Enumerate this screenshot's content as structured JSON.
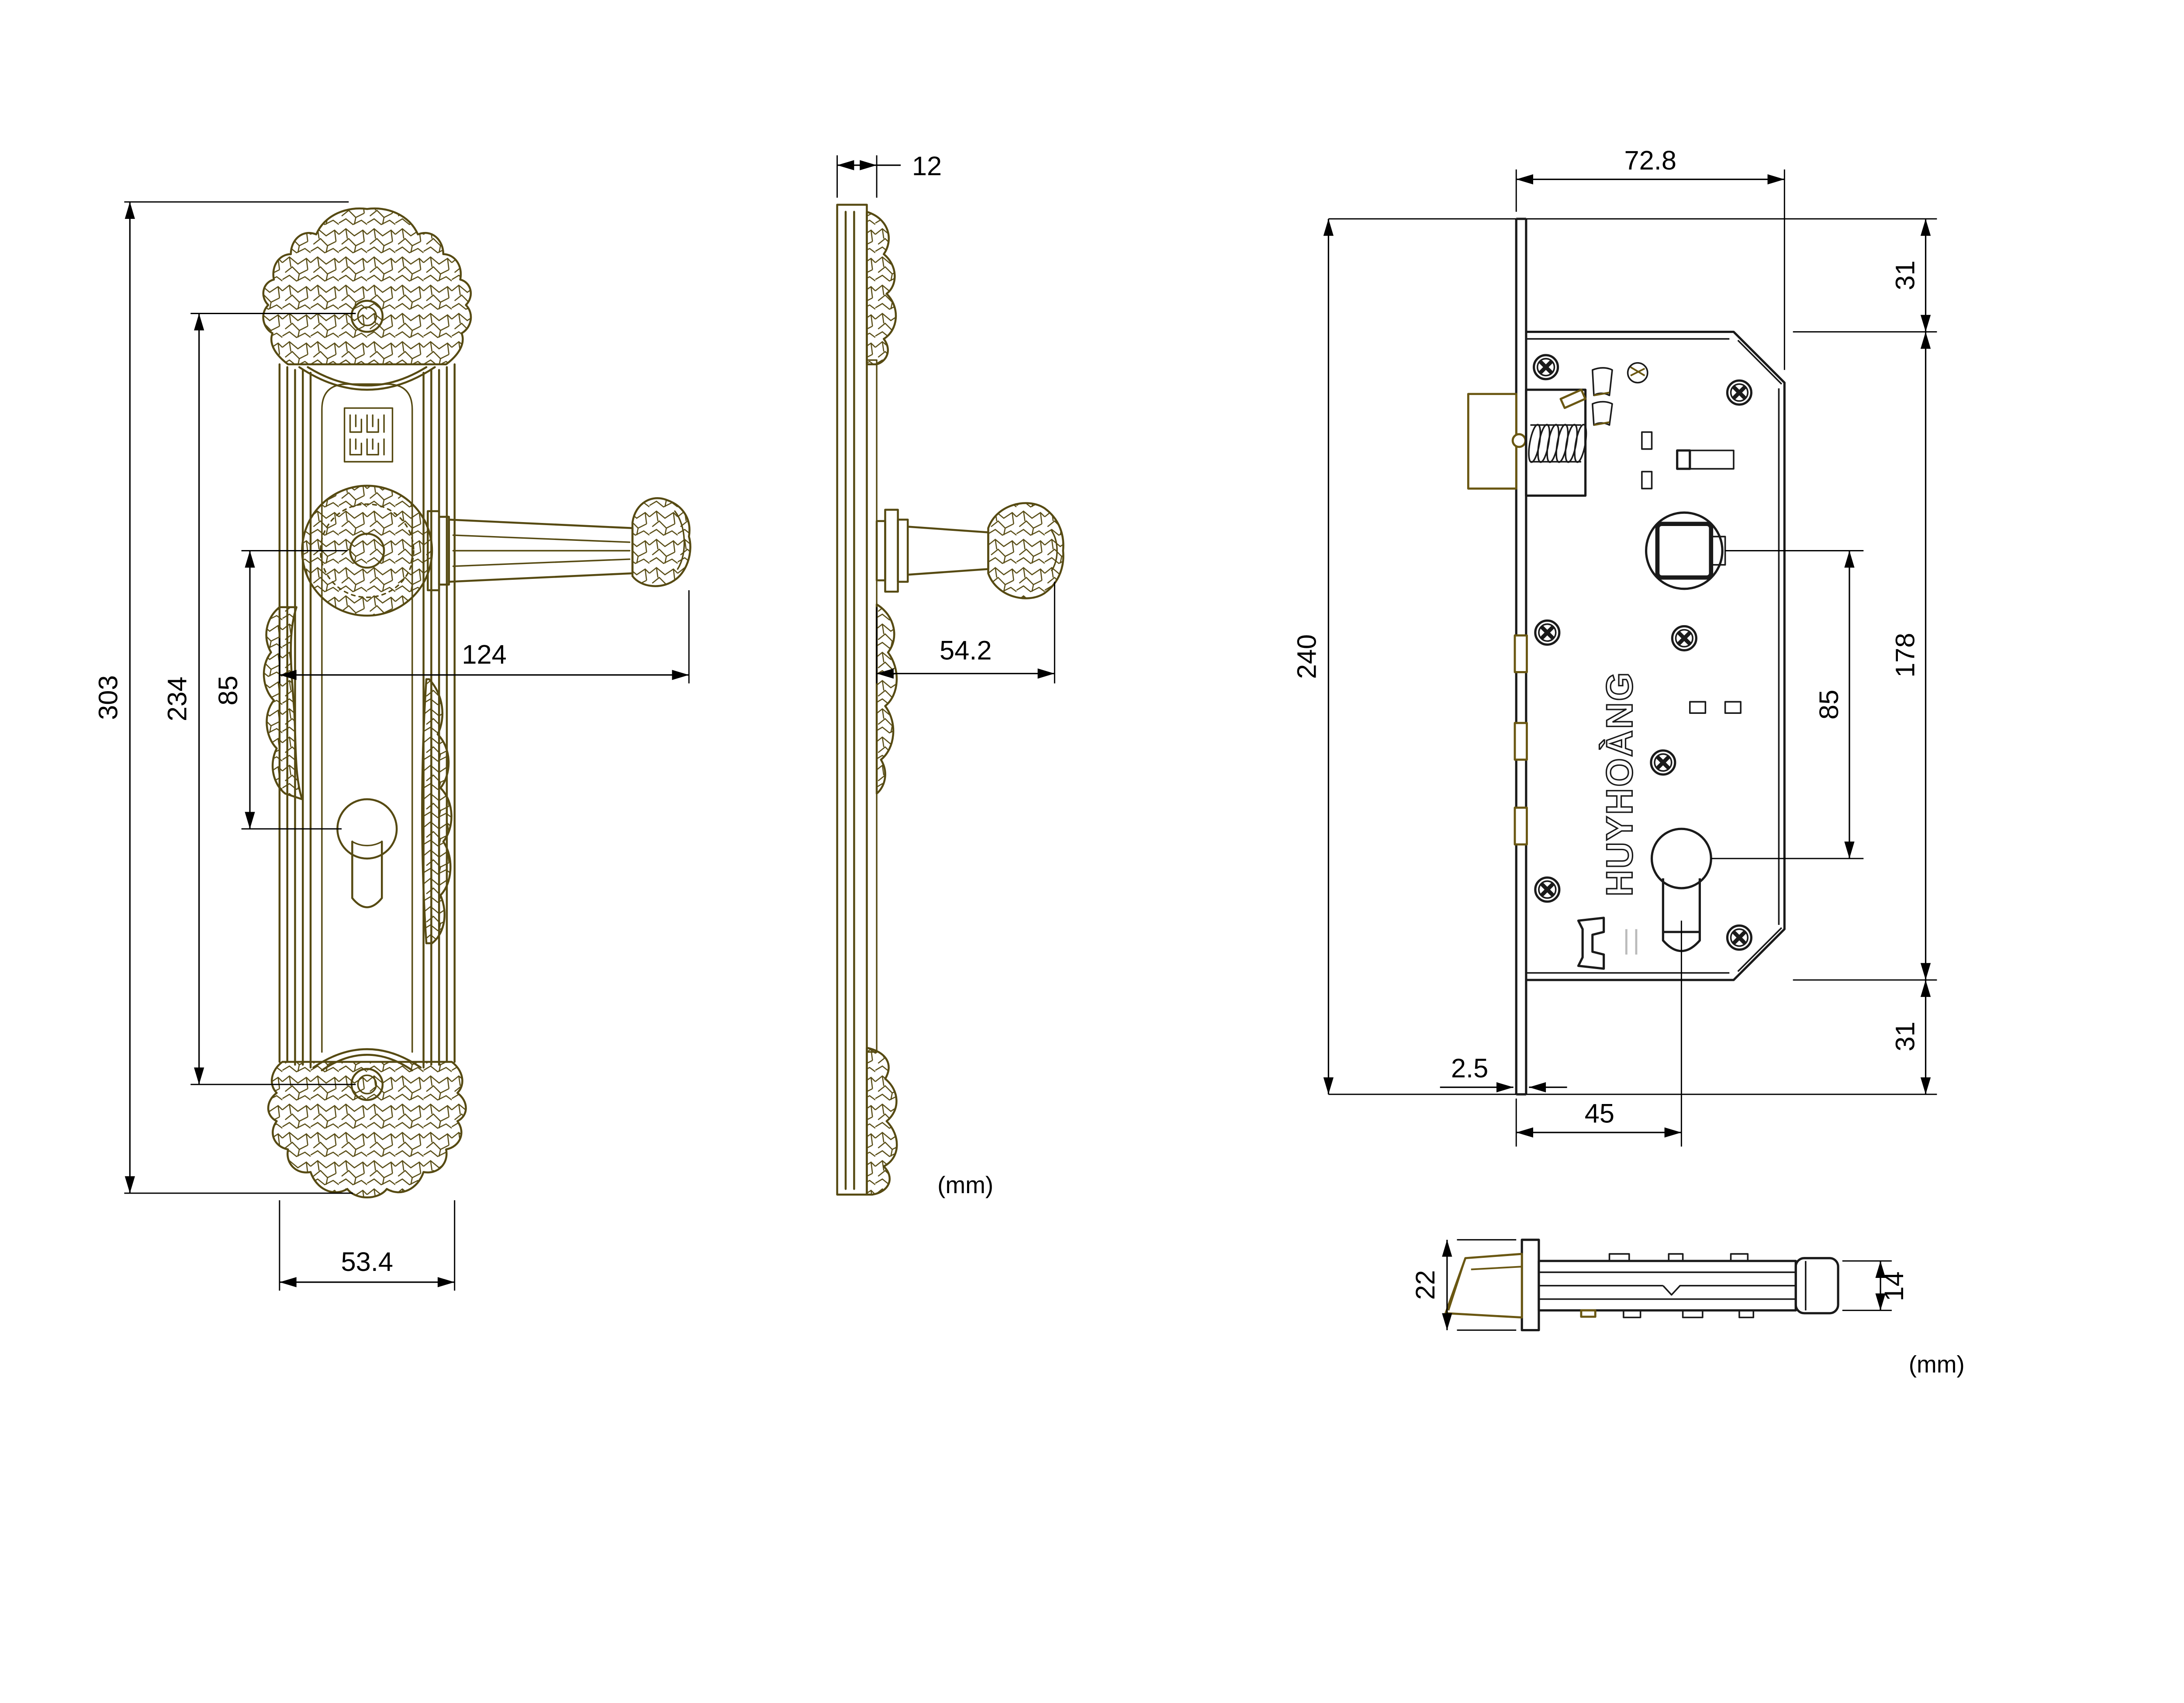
{
  "drawing": {
    "units_note_center": "(mm)",
    "units_note_corner": "(mm)",
    "brand_lock_text": "HUYHOÀNG",
    "brand_seal_text": "MAY MẮN",
    "colors": {
      "hardware_line": "#564a12",
      "lock_line": "#1a1a1a",
      "accent_brass": "#6a5712",
      "dimension": "#000000"
    },
    "views": {
      "handle_plate_front": {
        "dims": {
          "total_height": "303",
          "screw_centers": "234",
          "handle_to_keyhole": "85",
          "handle_length": "124",
          "plate_width": "53.4"
        }
      },
      "handle_plate_side": {
        "dims": {
          "plate_thickness": "12",
          "handle_projection": "54.2"
        }
      },
      "lock_body_front": {
        "dims": {
          "case_width": "72.8",
          "top_margin": "31",
          "faceplate_height": "240",
          "case_height": "178",
          "spindle_to_cylinder": "85",
          "bottom_margin": "31",
          "faceplate_thickness": "2.5",
          "backset": "45"
        }
      },
      "latch_bolt_side": {
        "dims": {
          "faceplate_width": "22",
          "bolt_height": "14"
        }
      }
    }
  }
}
